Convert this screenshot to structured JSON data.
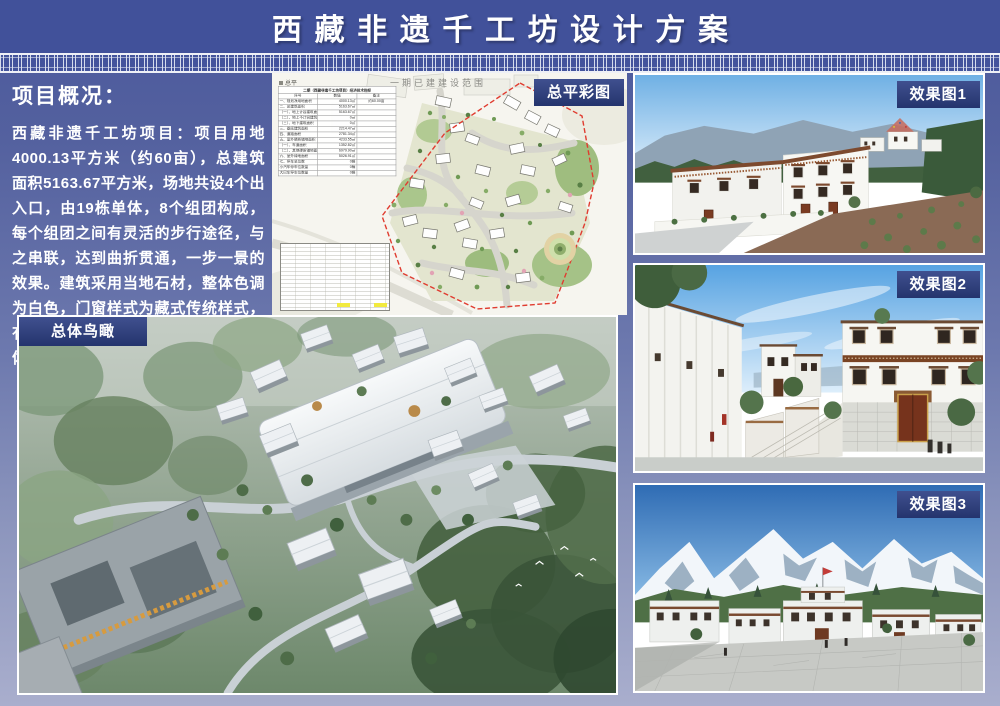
{
  "title": "西藏非遗千工坊设计方案",
  "overview": {
    "heading": "项目概况：",
    "body": "西藏非遗千工坊项目：项目用地4000.13平方米（约60亩），总建筑面积5163.67平方米，场地共设4个出入口，由19栋单体，8个组团构成，每个组团之间有灵活的步行途径，与之串联，达到曲折贯通，一步一景的效果。建筑采用当地石材，整体色调为白色，门窗样式为藏式传统样式，有着浓厚的藏式风味，符合片区的整体风貌。"
  },
  "site_plan": {
    "badge": "总平彩图",
    "plan_title": "一期已建建设范围",
    "corner_label": "总平",
    "table": {
      "title": "二期（西藏非遗千工坊项目）经济技术指标",
      "headers": [
        "序号",
        "数值",
        "备注"
      ],
      "rows": [
        {
          "label": "一、规划净用地面积",
          "value": "4000.13㎡",
          "note": "约60.00亩"
        },
        {
          "label": "二、总建筑面积",
          "value": "5163.67㎡",
          "note": ""
        },
        {
          "label": "（一）、地上计容建筑面积",
          "value": "5163.67㎡",
          "note": ""
        },
        {
          "label": "（二）、地上不计容建筑面积",
          "value": "0㎡",
          "note": ""
        },
        {
          "label": "（三）、地下建筑面积",
          "value": "0㎡",
          "note": ""
        },
        {
          "label": "三、基底建筑面积",
          "value": "2214.47㎡",
          "note": ""
        },
        {
          "label": "四、道路面积",
          "value": "2781.34㎡",
          "note": ""
        },
        {
          "label": "五、室外硬质铺地面积",
          "value": "4233.55㎡",
          "note": ""
        },
        {
          "label": "（一）、车道面积",
          "value": "1352.82㎡",
          "note": ""
        },
        {
          "label": "（二）、其他硬质铺地面积",
          "value": "6979.90㎡",
          "note": ""
        },
        {
          "label": "六、室外绿地面积",
          "value": "5026.91㎡",
          "note": ""
        },
        {
          "label": "七、停车总位数",
          "value": "0辆",
          "note": ""
        },
        {
          "label": "小汽车停车位数量",
          "value": "0辆",
          "note": ""
        },
        {
          "label": "大巴车停车位数量",
          "value": "0辆",
          "note": ""
        }
      ]
    }
  },
  "aerial": {
    "badge": "总体鸟瞰"
  },
  "renders": {
    "r1": "效果图1",
    "r2": "效果图2",
    "r3": "效果图3"
  },
  "colors": {
    "banner_blue": "#41519A",
    "badge_navy": "#24346D",
    "background_top": "#4A589C",
    "background_bottom": "#A9AECD",
    "boundary_red": "#E03C30",
    "highlight_yellow": "#F2EA3E"
  }
}
